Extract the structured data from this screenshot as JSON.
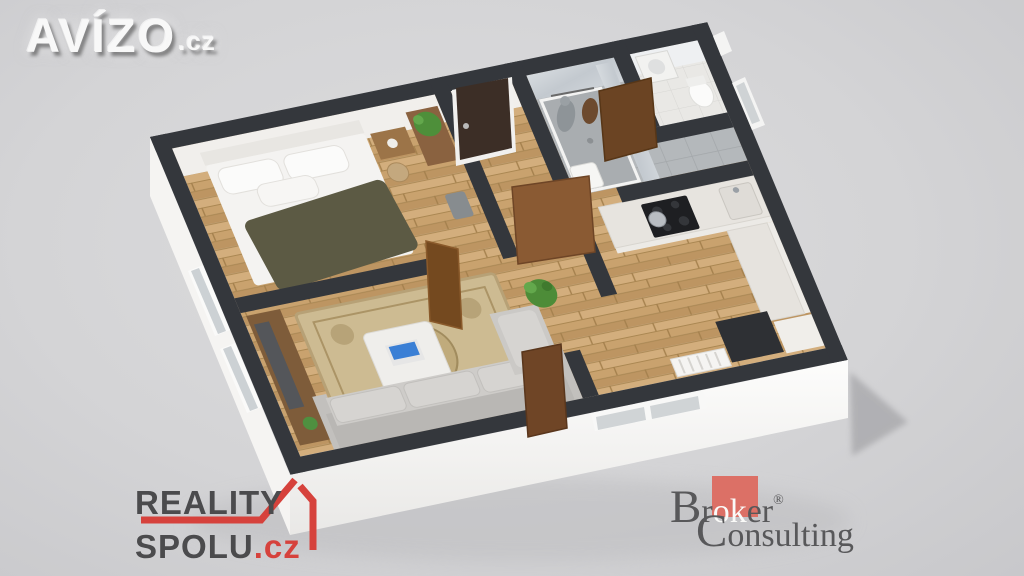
{
  "watermarks": {
    "avizo": {
      "name": "AVÍZO",
      "tld": ".cz",
      "color": "#f8f8f8"
    },
    "reality_spolu": {
      "line1": "REALITY",
      "line2": "SPOLU",
      "tld": ".cz",
      "text_color": "#4b4b4d",
      "accent_color": "#d6423c"
    },
    "broker_consulting": {
      "cap1": "B",
      "part1": "r",
      "part2": "ok",
      "part3": "er",
      "registered": "®",
      "cap2": "C",
      "rest2": "onsulting",
      "square_color": "#dc7066",
      "text_color": "#58585a"
    }
  },
  "scene": {
    "type": "3d-floorplan-render",
    "background_color": "#d5d5d7",
    "wall_top_color": "#34373c",
    "wood_floor_color": "#c9a26e",
    "bathroom_tile_color": "#b4b8bb",
    "rooms": [
      "bedroom",
      "living-room",
      "hallway",
      "bathroom",
      "toilet",
      "kitchen"
    ],
    "objects": [
      "double-bed",
      "pillows",
      "olive-blanket",
      "nightstand",
      "wicker-basket",
      "dresser-with-plant",
      "waste-bin",
      "tv-sideboard",
      "tv",
      "ornate-rug",
      "coffee-table",
      "laptop",
      "sofa",
      "potted-plant",
      "coat-hooks",
      "entry-door",
      "interior-doors",
      "shower",
      "washing-machine",
      "toilet-bowl",
      "kitchen-counter",
      "cooktop",
      "pot",
      "sink",
      "radiator",
      "windows"
    ]
  }
}
